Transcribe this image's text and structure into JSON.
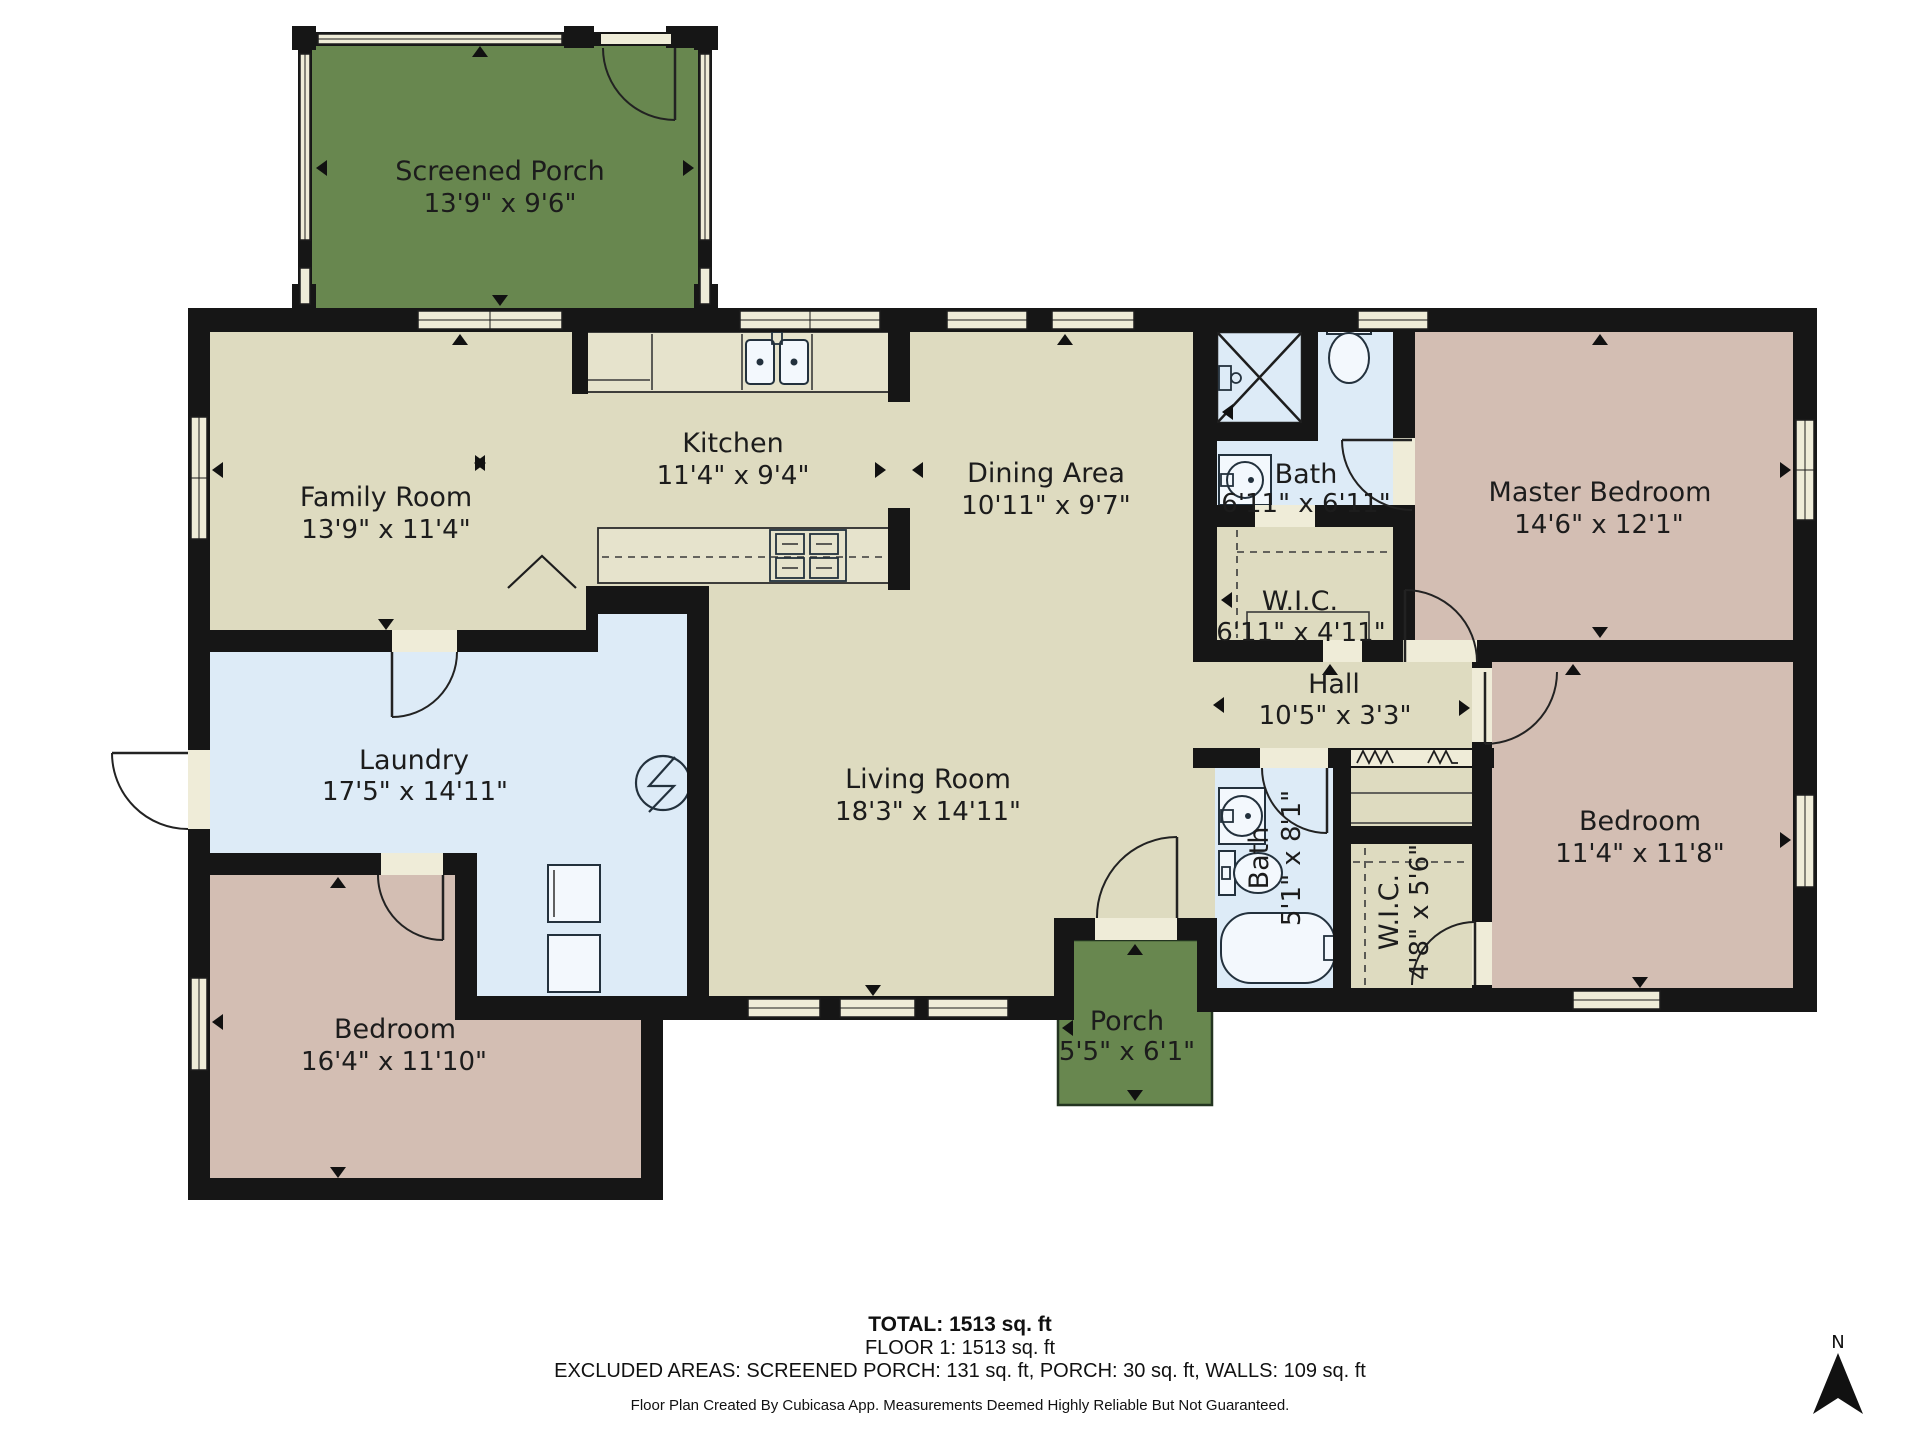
{
  "title": "Floor plan - Floor 1",
  "rooms": {
    "screened_porch": {
      "name": "Screened Porch",
      "dims": "13'9\" x 9'6\""
    },
    "family_room": {
      "name": "Family Room",
      "dims": "13'9\" x 11'4\""
    },
    "kitchen": {
      "name": "Kitchen",
      "dims": "11'4\" x 9'4\""
    },
    "dining_area": {
      "name": "Dining Area",
      "dims": "10'11\" x 9'7\""
    },
    "bath_upper": {
      "name": "Bath",
      "dims": "6'11\" x 6'11\""
    },
    "wic_upper": {
      "name": "W.I.C.",
      "dims": "6'11\" x 4'11\""
    },
    "master_bedroom": {
      "name": "Master Bedroom",
      "dims": "14'6\" x 12'1\""
    },
    "hall": {
      "name": "Hall",
      "dims": "10'5\" x 3'3\""
    },
    "laundry": {
      "name": "Laundry",
      "dims": "17'5\" x 14'11\""
    },
    "living_room": {
      "name": "Living Room",
      "dims": "18'3\" x 14'11\""
    },
    "bedroom_left": {
      "name": "Bedroom",
      "dims": "16'4\" x 11'10\""
    },
    "bath_lower": {
      "name": "Bath",
      "dims": "5'1\" x 8'1\""
    },
    "wic_lower": {
      "name": "W.I.C.",
      "dims": "4'8\" x 5'6\""
    },
    "bedroom_right": {
      "name": "Bedroom",
      "dims": "11'4\" x 11'8\""
    },
    "porch": {
      "name": "Porch",
      "dims": "5'5\" x 6'1\""
    }
  },
  "footer": {
    "total": "TOTAL: 1513 sq. ft",
    "floor": "FLOOR 1: 1513 sq. ft",
    "excluded": "EXCLUDED AREAS: SCREENED PORCH: 131 sq. ft, PORCH: 30 sq. ft, WALLS: 109 sq. ft",
    "attribution": "Floor Plan Created By Cubicasa App. Measurements Deemed Highly Reliable But Not Guaranteed."
  },
  "compass": {
    "north_label": "N"
  },
  "colors": {
    "wall": "#161616",
    "floor_main": "#dedbc0",
    "floor_wet": "#ddebf7",
    "floor_bedroom": "#d3beb3",
    "porch_green": "#68874f",
    "window_frame": "#efecd8"
  }
}
